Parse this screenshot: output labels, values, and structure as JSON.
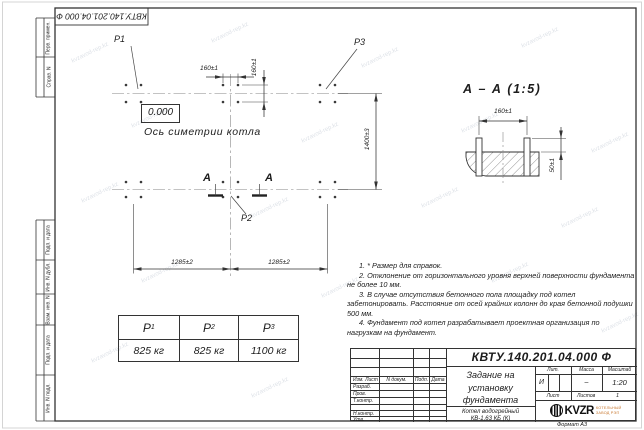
{
  "watermark": {
    "text": "kvzavod-rep.kz"
  },
  "stamp_top": {
    "doc_number": "КВТУ.140.201.04.000 Ф"
  },
  "margin": {
    "labels": [
      "Перв. примен.",
      "Справ. N",
      "Подп. и дата",
      "Инв. N дубл.",
      "Взам. инв. N",
      "Подп. и дата",
      "Инв. N подл."
    ]
  },
  "plan": {
    "p1": "P1",
    "p2": "P2",
    "p3": "P3",
    "elevation": "0.000",
    "axis_label": "Ось симетрии котла",
    "dim_bolt_x": "160±1",
    "dim_bolt_y": "160±1",
    "dim_width": "1400±3",
    "dim_span_left": "1285±2",
    "dim_span_right": "1285±2",
    "section_letter": "А"
  },
  "section_view": {
    "title": "А – А (1:5)",
    "dim_bolt_spacing": "160±1",
    "dim_protrusion": "50±1"
  },
  "load_table": {
    "headers": [
      {
        "base": "P",
        "sub": "1"
      },
      {
        "base": "P",
        "sub": "2"
      },
      {
        "base": "P",
        "sub": "3"
      }
    ],
    "values": [
      "825 кг",
      "825 кг",
      "1100 кг"
    ]
  },
  "notes": {
    "items": [
      "1. * Размер для справок.",
      "2. Отклонение от горизонтального уровня верхней поверхности фундамента не более 10 мм.",
      "3. В случае отсутствия бетонного пола площадку под котел забетонировать. Расстояние от осей крайних колонн до края бетонной подушки 500 мм.",
      "4. Фундамент под котел разрабатывает проектная организация по нагрузкам на фундамент."
    ]
  },
  "title_block": {
    "doc_number": "КВТУ.140.201.04.000 Ф",
    "title_lines": [
      "Задание на",
      "установку",
      "фундамента"
    ],
    "product_lines": [
      "Котел водогрейный",
      "КВ-1,63 КБ (К)"
    ],
    "cols": {
      "izm": "Изм. Лист",
      "doc": "N докум.",
      "podp": "Подп.",
      "data": "Дата"
    },
    "rows": [
      "Разраб.",
      "Пров.",
      "Т.контр.",
      "Н.контр.",
      "Утв."
    ],
    "lit_label": "Лит.",
    "mass_label": "Масса",
    "scale_label": "Масштаб",
    "lit": "И",
    "mass": "–",
    "scale": "1:20",
    "sheet_label": "Лист",
    "sheets_label": "Листов",
    "sheets_value": "1",
    "logo_text": "KVZR",
    "logo_sub_lines": [
      "КОТЕЛЬНЫЙ",
      "ЗАВОД РЭП"
    ],
    "format_note": "Формат А3"
  }
}
